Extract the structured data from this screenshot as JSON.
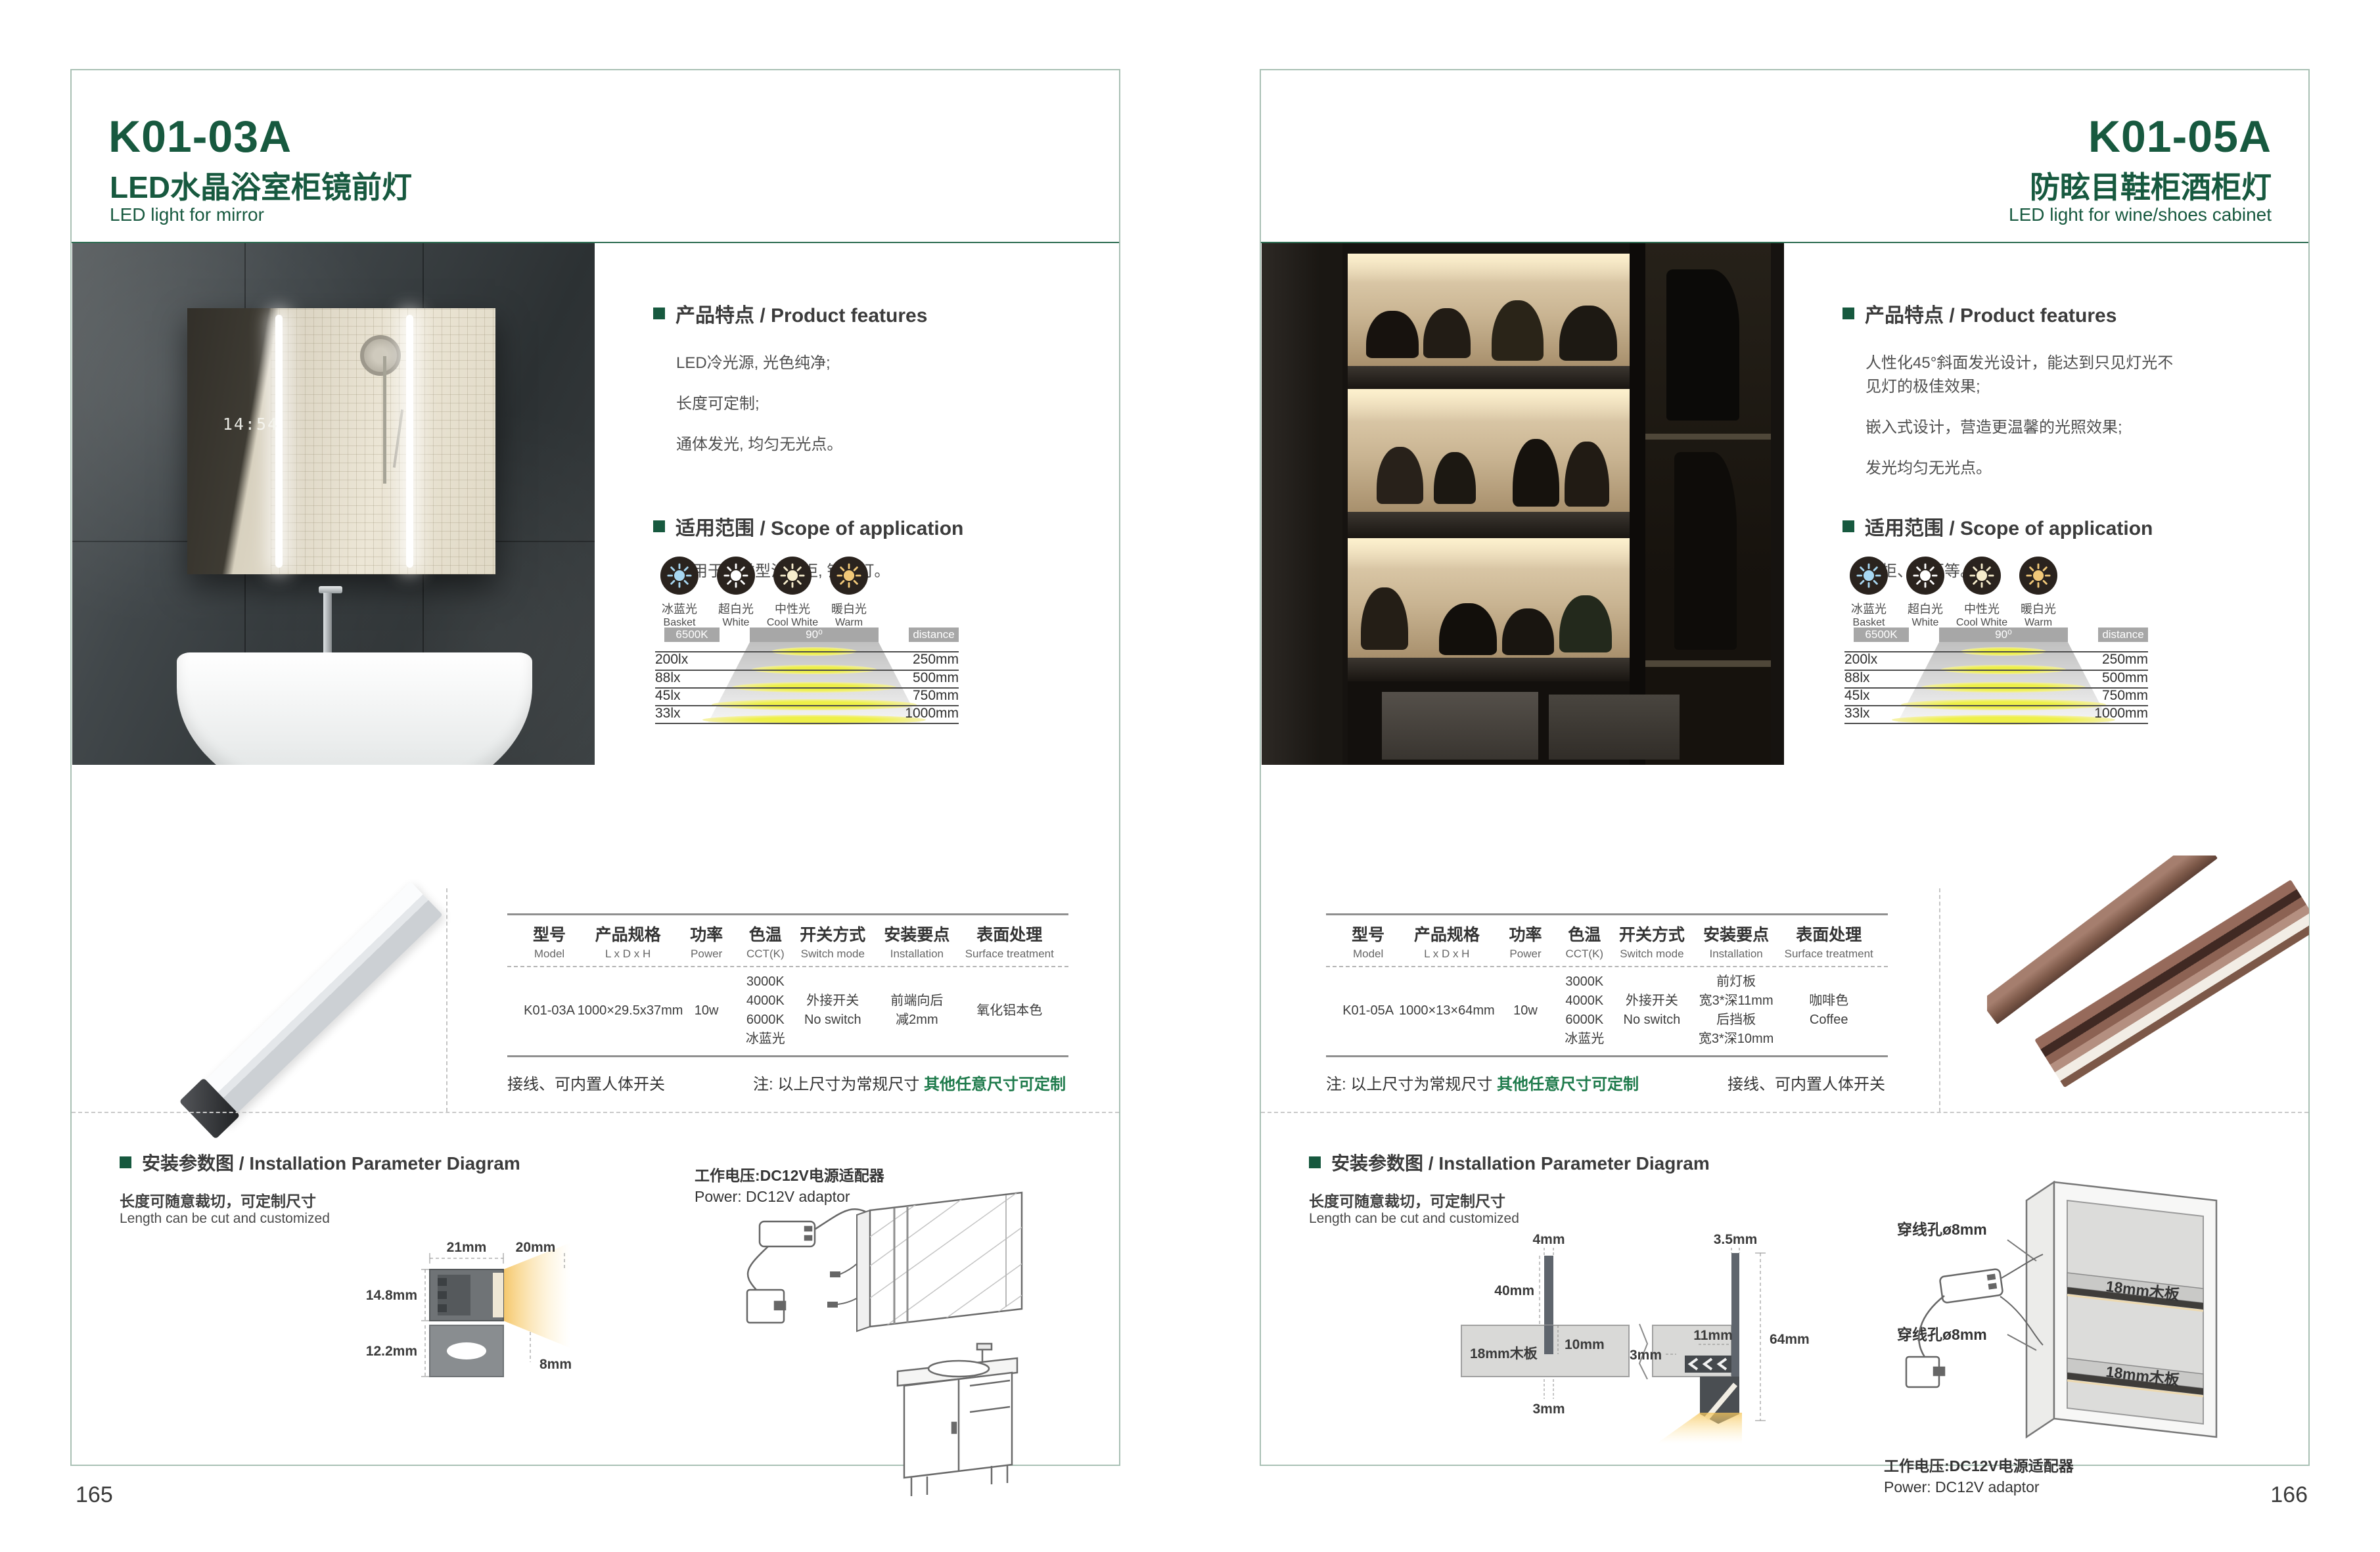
{
  "brand": {
    "green": "#17593f",
    "note_green": "#1e7a4b"
  },
  "light_modes": [
    {
      "zh": "冰蓝光",
      "en": "Basket",
      "color": "#a8d8f2"
    },
    {
      "zh": "超白光",
      "en": "White",
      "color": "#ffffff"
    },
    {
      "zh": "中性光",
      "en": "Cool White",
      "color": "#f6eccc"
    },
    {
      "zh": "暖白光",
      "en": "Warm White",
      "color": "#f2c979"
    }
  ],
  "beam_chart": {
    "type": "table",
    "cct": "6500K",
    "angle": "90⁰",
    "distance_label": "distance",
    "rows": [
      {
        "lux": "200lx",
        "distance": "250mm"
      },
      {
        "lux": "88lx",
        "distance": "500mm"
      },
      {
        "lux": "45lx",
        "distance": "750mm"
      },
      {
        "lux": "33lx",
        "distance": "1000mm"
      }
    ]
  },
  "table_headers": [
    {
      "zh": "型号",
      "en": "Model"
    },
    {
      "zh": "产品规格",
      "en": "L x D x H"
    },
    {
      "zh": "功率",
      "en": "Power"
    },
    {
      "zh": "色温",
      "en": "CCT(K)"
    },
    {
      "zh": "开关方式",
      "en": "Switch mode"
    },
    {
      "zh": "安装要点",
      "en": "Installation"
    },
    {
      "zh": "表面处理",
      "en": "Surface treatment"
    }
  ],
  "pages": [
    {
      "model": "K01-03A",
      "title_zh": "LED水晶浴室柜镜前灯",
      "title_en": "LED light for mirror",
      "page_number": "165",
      "features_heading": "产品特点 / Product features",
      "features": [
        "LED冷光源, 光色纯净;",
        "长度可定制;",
        "通体发光, 均匀无光点。"
      ],
      "scope_heading": "适用范围 / Scope of application",
      "scope": "应用于各类型浴室柜, 镜前灯。",
      "photo_clock": "14:54",
      "row": {
        "model": "K01-03A",
        "size": "1000×29.5x37mm",
        "power": "10w",
        "cct": [
          "3000K",
          "4000K",
          "6000K",
          "冰蓝光"
        ],
        "switch": [
          "外接开关",
          "No switch"
        ],
        "install": [
          "前端向后",
          "减2mm"
        ],
        "surface": [
          "氧化铝本色"
        ]
      },
      "note_left": "接线、可内置人体开关",
      "note_right_prefix": "注: 以上尺寸为常规尺寸 ",
      "note_right_green": "其他任意尺寸可定制",
      "install_heading": "安装参数图 / Installation Parameter Diagram",
      "install_sub_zh": "长度可随意裁切，可定制尺寸",
      "install_sub_en": "Length can be cut and customized",
      "power_zh": "工作电压:DC12V电源适配器",
      "power_en": "Power: DC12V adaptor",
      "diagram_dims": {
        "top_w": "21mm",
        "glow_w": "20mm",
        "h_upper": "14.8mm",
        "h_lower": "12.2mm",
        "glow_h": "8mm"
      }
    },
    {
      "model": "K01-05A",
      "title_zh": "防眩目鞋柜酒柜灯",
      "title_en": "LED light for wine/shoes cabinet",
      "page_number": "166",
      "features_heading": "产品特点 / Product features",
      "features": [
        "人性化45°斜面发光设计，能达到只见灯光不见灯的极佳效果;",
        "嵌入式设计，营造更温馨的光照效果;",
        "发光均匀无光点。"
      ],
      "scope_heading": "适用范围 / Scope of application",
      "scope": "鞋柜、酒柜等。",
      "row": {
        "model": "K01-05A",
        "size": "1000×13×64mm",
        "power": "10w",
        "cct": [
          "3000K",
          "4000K",
          "6000K",
          "冰蓝光"
        ],
        "switch": [
          "外接开关",
          "No switch"
        ],
        "install": [
          "前灯板",
          "宽3*深11mm",
          "后挡板",
          "宽3*深10mm"
        ],
        "surface": [
          "咖啡色",
          "Coffee"
        ]
      },
      "note_left_prefix": "注: 以上尺寸为常规尺寸 ",
      "note_left_green": "其他任意尺寸可定制",
      "note_right": "接线、可内置人体开关",
      "install_heading": "安装参数图 / Installation Parameter Diagram",
      "install_sub_zh": "长度可随意裁切，可定制尺寸",
      "install_sub_en": "Length can be cut and customized",
      "power_zh": "工作电压:DC12V电源适配器",
      "power_en": "Power: DC12V adaptor",
      "diagram_dims": {
        "slot_left": "4mm",
        "slot_right": "3.5mm",
        "bar_h": "40mm",
        "board": "18mm木板",
        "depth": "10mm",
        "bottom": "3mm",
        "side": "3mm",
        "front": "11mm",
        "total": "64mm"
      },
      "cabinet_labels": {
        "hole_top": "穿线孔ø8mm",
        "hole_bottom": "穿线孔ø8mm",
        "board_top": "18mm木板",
        "board_bottom": "18mm木板"
      }
    }
  ]
}
